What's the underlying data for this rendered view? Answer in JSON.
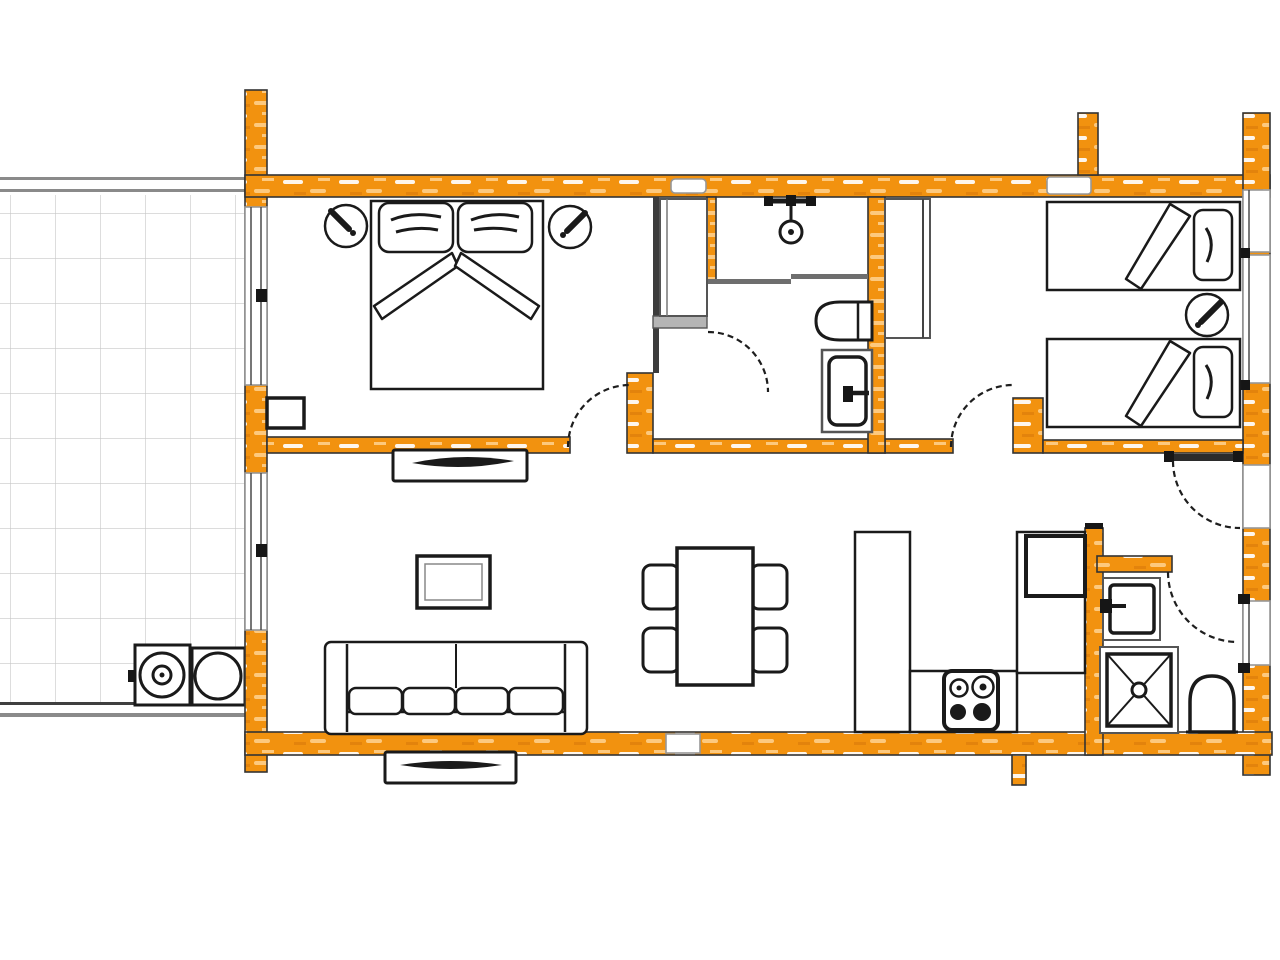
{
  "meta": {
    "kind": "architectural-floor-plan",
    "visible_text": "none"
  },
  "palette": {
    "bg": "#ffffff",
    "wall": "#F2920F",
    "wall-hl": "#ffffff",
    "wall-hl2": "#FDC97E",
    "wall-dk": "#D8790A",
    "outline": "#333333",
    "partition": "#6e6e6e",
    "ink": "#1a1a1a",
    "grid": "#c6c6c6",
    "winframe": "#979797",
    "terrace-border": "#8a8a8a"
  },
  "rooms": [
    {
      "name": "terrace",
      "items": [
        "tile-grid",
        "grill-unit-double-ring",
        "grill-unit-single-ring"
      ]
    },
    {
      "name": "bedroom-1",
      "items": [
        "double-bed",
        "pillow-left",
        "pillow-right",
        "v-blanket",
        "bedside-lamp-left",
        "bedside-lamp-right",
        "radiator",
        "terrace-window"
      ]
    },
    {
      "name": "hallway",
      "items": [
        "wardrobe"
      ]
    },
    {
      "name": "bathroom",
      "items": [
        "shower-head",
        "shower-screen",
        "toilet",
        "washbasin"
      ]
    },
    {
      "name": "bedroom-2",
      "items": [
        "single-bed-top",
        "single-bed-bottom",
        "pillow-top",
        "pillow-bottom",
        "wedge-blanket-top",
        "wedge-blanket-bottom",
        "bedside-lamp",
        "wardrobe"
      ]
    },
    {
      "name": "living-room",
      "items": [
        "tv-sideboard-upper",
        "coffee-table",
        "sofa-4-cushion",
        "tv-sideboard-lower",
        "dining-table",
        "chair-1",
        "chair-2",
        "chair-3",
        "chair-4"
      ]
    },
    {
      "name": "kitchen",
      "items": [
        "counter-left-arm",
        "counter-bottom-strip",
        "tall-cabinet",
        "fridge",
        "stove-4-burner",
        "chimney-stub"
      ]
    },
    {
      "name": "shower-room",
      "items": [
        "washbasin",
        "shower-tray",
        "toilet"
      ]
    }
  ],
  "doors": [
    "living-to-hall-door",
    "bathroom-door",
    "bedroom-2-door",
    "entry-door",
    "shower-room-door"
  ],
  "window_count": 9
}
